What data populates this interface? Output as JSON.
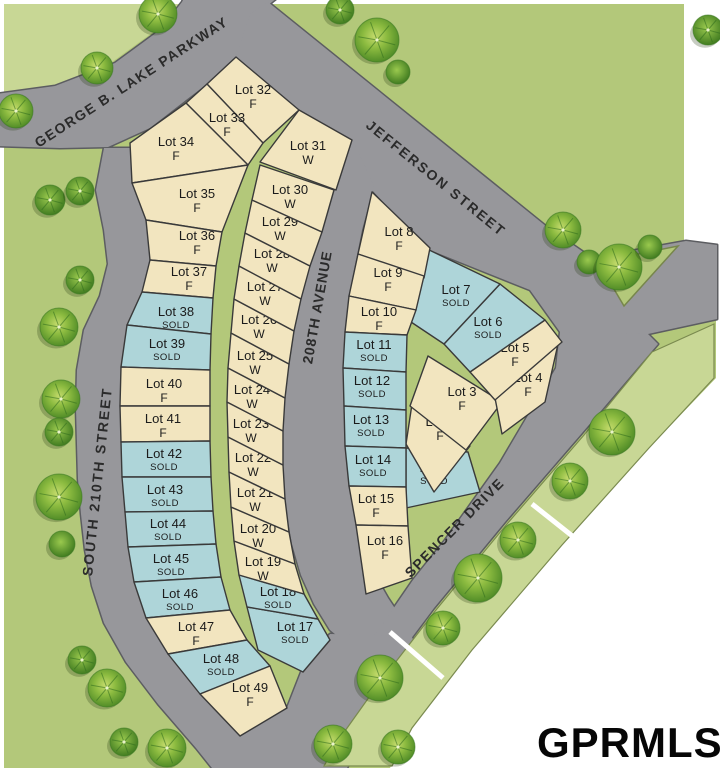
{
  "map": {
    "watermark": "GPRMLS",
    "streets": [
      {
        "id": "parkway",
        "name": "GEORGE B. LAKE PARKWAY"
      },
      {
        "id": "jefferson",
        "name": "JEFFERSON STREET"
      },
      {
        "id": "ave208",
        "name": "208TH AVENUE"
      },
      {
        "id": "s210",
        "name": "SOUTH 210TH STREET"
      },
      {
        "id": "spencer",
        "name": "SPENCER DRIVE"
      }
    ],
    "lots": [
      {
        "label": "Lot 1",
        "status": "SOLD"
      },
      {
        "label": "Lot 2",
        "status": "F"
      },
      {
        "label": "Lot 3",
        "status": "F"
      },
      {
        "label": "Lot 4",
        "status": "F"
      },
      {
        "label": "Lot 5",
        "status": "F"
      },
      {
        "label": "Lot 6",
        "status": "SOLD"
      },
      {
        "label": "Lot 7",
        "status": "SOLD"
      },
      {
        "label": "Lot 8",
        "status": "F"
      },
      {
        "label": "Lot 9",
        "status": "F"
      },
      {
        "label": "Lot 10",
        "status": "F"
      },
      {
        "label": "Lot 11",
        "status": "SOLD"
      },
      {
        "label": "Lot 12",
        "status": "SOLD"
      },
      {
        "label": "Lot 13",
        "status": "SOLD"
      },
      {
        "label": "Lot 14",
        "status": "SOLD"
      },
      {
        "label": "Lot 15",
        "status": "F"
      },
      {
        "label": "Lot 16",
        "status": "F"
      },
      {
        "label": "Lot 17",
        "status": "SOLD"
      },
      {
        "label": "Lot 18",
        "status": "SOLD"
      },
      {
        "label": "Lot 19",
        "status": "W"
      },
      {
        "label": "Lot 20",
        "status": "W"
      },
      {
        "label": "Lot 21",
        "status": "W"
      },
      {
        "label": "Lot 22",
        "status": "W"
      },
      {
        "label": "Lot 23",
        "status": "W"
      },
      {
        "label": "Lot 24",
        "status": "W"
      },
      {
        "label": "Lot 25",
        "status": "W"
      },
      {
        "label": "Lot 26",
        "status": "W"
      },
      {
        "label": "Lot 27",
        "status": "W"
      },
      {
        "label": "Lot 28",
        "status": "W"
      },
      {
        "label": "Lot 29",
        "status": "W"
      },
      {
        "label": "Lot 30",
        "status": "W"
      },
      {
        "label": "Lot 31",
        "status": "W"
      },
      {
        "label": "Lot 32",
        "status": "F"
      },
      {
        "label": "Lot 33",
        "status": "F"
      },
      {
        "label": "Lot 34",
        "status": "F"
      },
      {
        "label": "Lot 35",
        "status": "F"
      },
      {
        "label": "Lot 36",
        "status": "F"
      },
      {
        "label": "Lot 37",
        "status": "F"
      },
      {
        "label": "Lot 38",
        "status": "SOLD"
      },
      {
        "label": "Lot 39",
        "status": "SOLD"
      },
      {
        "label": "Lot 40",
        "status": "F"
      },
      {
        "label": "Lot 41",
        "status": "F"
      },
      {
        "label": "Lot 42",
        "status": "SOLD"
      },
      {
        "label": "Lot 43",
        "status": "SOLD"
      },
      {
        "label": "Lot 44",
        "status": "SOLD"
      },
      {
        "label": "Lot 45",
        "status": "SOLD"
      },
      {
        "label": "Lot 46",
        "status": "SOLD"
      },
      {
        "label": "Lot 47",
        "status": "F"
      },
      {
        "label": "Lot 48",
        "status": "SOLD"
      },
      {
        "label": "Lot 49",
        "status": "F"
      }
    ],
    "colors": {
      "grass": "#b3c87a",
      "grass_light": "#c8d795",
      "road": "#97979b",
      "road_edge": "#5c5d61",
      "lot_available": "#f2e5bf",
      "lot_sold": "#aed5d9",
      "lot_border": "#3a3a3a"
    }
  }
}
